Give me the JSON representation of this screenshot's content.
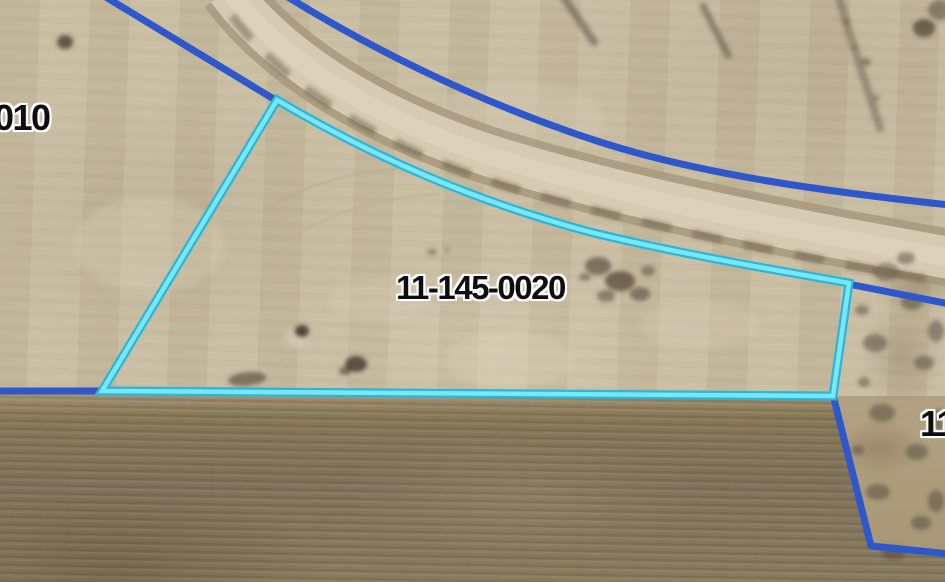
{
  "map_view": {
    "parcel_labels": {
      "west": "010",
      "highlighted": "11-145-0020",
      "east": "11"
    },
    "colors": {
      "boundary_blue": "#2d57cb",
      "highlight_outer": "#2db5d8",
      "highlight_inner": "#78e7f8",
      "label_text": "#0e0e10",
      "label_halo": "#ffffff"
    }
  }
}
